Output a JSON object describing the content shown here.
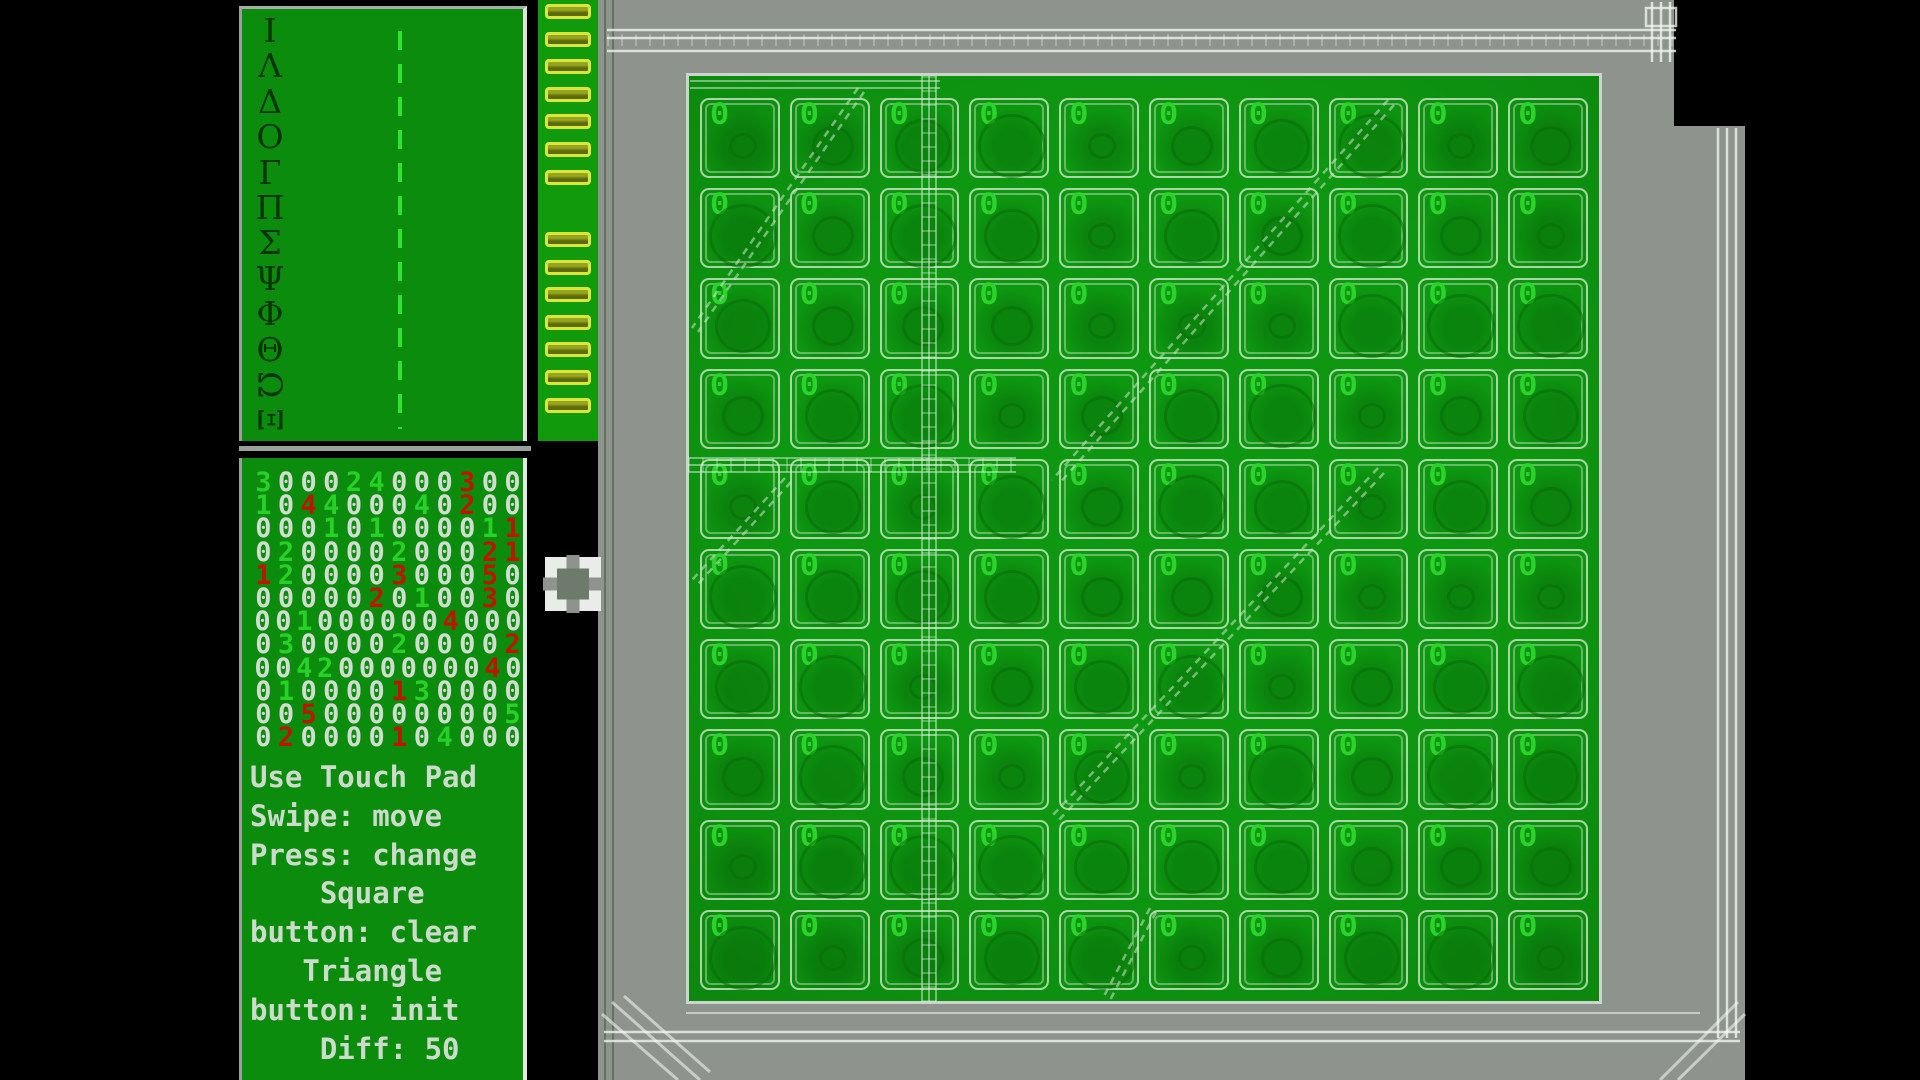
{
  "app": {
    "name": "number-puzzle-board-game"
  },
  "letters_panel": {
    "letters": [
      "Ι",
      "Λ",
      "Δ",
      "Ο",
      "Γ",
      "Π",
      "Σ",
      "Ψ",
      "Φ",
      "Θ",
      "Ω",
      "Ξ"
    ],
    "rotated_letters": [
      "Ω",
      "Ξ"
    ]
  },
  "status_panel": {
    "digit_colors": {
      "w": "#d0ddd0",
      "g": "#27d127",
      "r": "#c01400"
    },
    "digit_rows": [
      [
        "3g",
        "0w",
        "0w",
        "0w",
        "2g",
        "4g",
        "0w",
        "0w",
        "0w",
        "3r",
        "0w",
        "0w"
      ],
      [
        "1g",
        "0w",
        "4r",
        "4g",
        "0w",
        "0w",
        "0w",
        "4g",
        "0w",
        "2r",
        "0w",
        "0w"
      ],
      [
        "0w",
        "0w",
        "0w",
        "1g",
        "0w",
        "1g",
        "0w",
        "0w",
        "0w",
        "0w",
        "1g",
        "1r"
      ],
      [
        "0w",
        "2g",
        "0w",
        "0w",
        "0w",
        "0w",
        "2g",
        "0w",
        "0w",
        "0w",
        "2r",
        "1r"
      ],
      [
        "1r",
        "2g",
        "0w",
        "0w",
        "0w",
        "0w",
        "3r",
        "0w",
        "0w",
        "0w",
        "5r",
        "0w"
      ],
      [
        "0w",
        "0w",
        "0w",
        "0w",
        "0w",
        "2r",
        "0w",
        "1g",
        "0w",
        "0w",
        "3r",
        "0w"
      ],
      [
        "0w",
        "0w",
        "1g",
        "0w",
        "0w",
        "0w",
        "0w",
        "0w",
        "0w",
        "4r",
        "0w",
        "0w",
        "0w"
      ],
      [
        "0w",
        "3g",
        "0w",
        "0w",
        "0w",
        "0w",
        "2g",
        "0w",
        "0w",
        "0w",
        "0w",
        "2r"
      ],
      [
        "0w",
        "0w",
        "4g",
        "2g",
        "0w",
        "0w",
        "0w",
        "0w",
        "0w",
        "0w",
        "0w",
        "4r",
        "0w"
      ],
      [
        "0w",
        "1g",
        "0w",
        "0w",
        "0w",
        "0w",
        "1r",
        "3g",
        "0w",
        "0w",
        "0w",
        "0w"
      ],
      [
        "0w",
        "0w",
        "5r",
        "0w",
        "0w",
        "0w",
        "0w",
        "0w",
        "0w",
        "0w",
        "0w",
        "5g"
      ],
      [
        "0w",
        "2r",
        "0w",
        "0w",
        "0w",
        "0w",
        "1r",
        "0w",
        "4g",
        "0w",
        "0w",
        "0w"
      ]
    ],
    "instructions": [
      "Use Touch Pad",
      "Swipe: move",
      "Press: change",
      "    Square",
      "button: clear",
      "   Triangle",
      "button: init",
      "    Diff: 50"
    ]
  },
  "connector": {
    "pin_groups": [
      7,
      7
    ]
  },
  "board": {
    "rows": 10,
    "cols": 10,
    "cell_value": "0",
    "value_color": "#2bd42b",
    "board_green": "#0e9711"
  },
  "icons": {
    "bracket_selector": "selection-frame"
  },
  "colors": {
    "panel_green": "#0c8c0c",
    "connector_green": "#109a0c",
    "pin_yellow": "#dce63a",
    "table_gray": "#8e948d",
    "instruction_text": "#ccdbcc",
    "dashed_line_green": "#2fe42f",
    "background": "#000000"
  }
}
